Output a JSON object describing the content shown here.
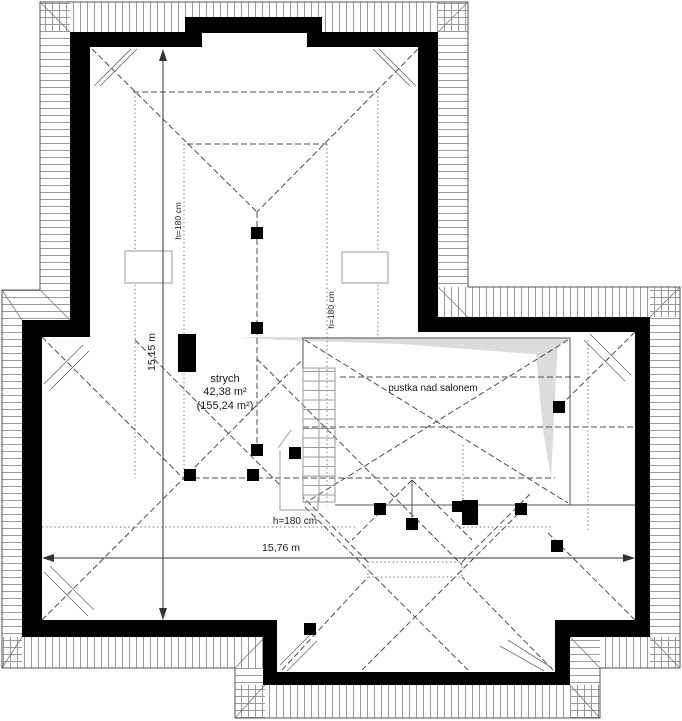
{
  "plan": {
    "room": {
      "name": "strych",
      "area": "42,38 m²",
      "area_total": "(155,24 m²)"
    },
    "void_label": "pustka nad salonem",
    "heights": {
      "left_vertical": "h=180 cm",
      "center_vertical": "h=180 cm",
      "bottom_horizontal": "h=180 cm"
    },
    "dimensions": {
      "vertical": "15,15 m",
      "horizontal": "15,76 m"
    }
  },
  "colors": {
    "wall": "#000000",
    "hatch": "#999999",
    "dash": "#4d4d4d",
    "shade": "#dcdcdc",
    "text": "#1a1a1a",
    "background": "#ffffff"
  }
}
